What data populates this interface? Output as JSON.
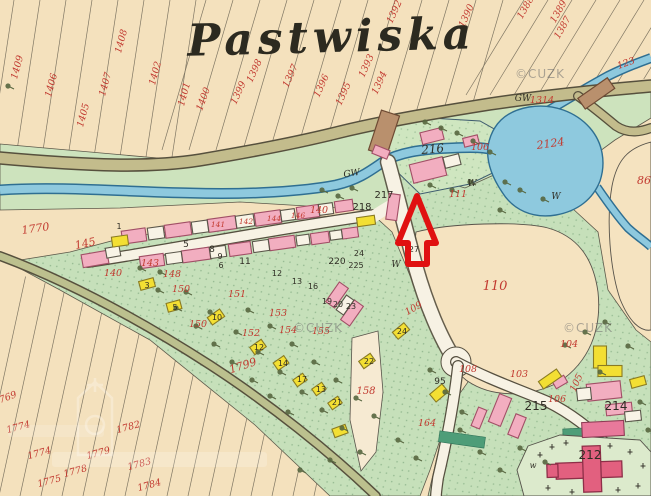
{
  "map": {
    "title": "Pastwiska",
    "watermark": "©CUZK",
    "arrow_color": "#e01111",
    "palette": {
      "field_cream": "#f4e1bd",
      "meadow_green": "#cde3bd",
      "garden_green": "#c6e0ba",
      "water_blue": "#8ec9de",
      "road_olive": "#c3bc8c",
      "road_white": "#f7f2e4",
      "building_pink": "#f2aec0",
      "building_yellow": "#f3df33",
      "church_red": "#e2607f",
      "bridge_brown": "#b9906d",
      "number_red": "#c23a30",
      "ink_black": "#2f2d24"
    },
    "parcel_numbers_red": [
      [
        "1409",
        20,
        68,
        -75
      ],
      [
        "1408",
        124,
        42,
        -75
      ],
      [
        "1407",
        108,
        85,
        -75
      ],
      [
        "1406",
        54,
        86,
        -75
      ],
      [
        "1405",
        86,
        116,
        -75
      ],
      [
        "1402",
        158,
        74,
        -75
      ],
      [
        "1401",
        187,
        95,
        -75
      ],
      [
        "1400",
        206,
        100,
        -70
      ],
      [
        "1399",
        241,
        94,
        -65
      ],
      [
        "1398",
        257,
        72,
        -65
      ],
      [
        "1397",
        293,
        77,
        -65
      ],
      [
        "1396",
        324,
        87,
        -65
      ],
      [
        "1395",
        346,
        95,
        -65
      ],
      [
        "1394",
        382,
        84,
        -65
      ],
      [
        "1393",
        369,
        67,
        -65
      ],
      [
        "1392",
        397,
        13,
        -65
      ],
      [
        "1390",
        469,
        17,
        -65
      ],
      [
        "1388",
        528,
        9,
        -60
      ],
      [
        "1389",
        561,
        13,
        -60
      ],
      [
        "1387",
        565,
        29,
        -60
      ],
      [
        "123",
        627,
        66,
        -20
      ],
      [
        "1314",
        542,
        103,
        0
      ],
      [
        "2124",
        551,
        147,
        -8,
        11
      ],
      [
        "86",
        644,
        184,
        0,
        11
      ],
      [
        "1770",
        36,
        232,
        -8,
        11
      ],
      [
        "145",
        86,
        247,
        -12,
        11
      ],
      [
        "140",
        113,
        276,
        0
      ],
      [
        "140",
        319,
        213,
        0
      ],
      [
        "143",
        150,
        266,
        0
      ],
      [
        "141",
        218,
        227,
        0,
        7.5
      ],
      [
        "142",
        246,
        224,
        0,
        7.5
      ],
      [
        "144",
        274,
        221,
        0,
        7.5
      ],
      [
        "146",
        298,
        218,
        0,
        7.5
      ],
      [
        "148",
        172,
        277,
        0
      ],
      [
        "150",
        181,
        292,
        0
      ],
      [
        "150",
        198,
        327,
        0
      ],
      [
        "151",
        237,
        297,
        0
      ],
      [
        "152",
        251,
        336,
        0
      ],
      [
        "153",
        278,
        316,
        0
      ],
      [
        "154",
        288,
        333,
        0
      ],
      [
        "155",
        321,
        334,
        0
      ],
      [
        "158",
        366,
        394,
        0,
        10
      ],
      [
        "1799",
        244,
        369,
        -18,
        11
      ],
      [
        "1769",
        6,
        401,
        -20
      ],
      [
        "1774",
        19,
        430,
        -15
      ],
      [
        "1774",
        40,
        456,
        -15
      ],
      [
        "1779",
        99,
        456,
        -15
      ],
      [
        "1778",
        76,
        474,
        -15
      ],
      [
        "1775",
        50,
        484,
        -15
      ],
      [
        "1782",
        129,
        430,
        -15
      ],
      [
        "1783",
        140,
        467,
        -15
      ],
      [
        "1784",
        150,
        488,
        -15
      ],
      [
        "106",
        480,
        150,
        0
      ],
      [
        "111",
        458,
        197,
        0
      ],
      [
        "110",
        495,
        290,
        0,
        13
      ],
      [
        "109",
        415,
        311,
        -30
      ],
      [
        "108",
        468,
        372,
        0
      ],
      [
        "104",
        569,
        347,
        0
      ],
      [
        "103",
        519,
        377,
        0
      ],
      [
        "105",
        579,
        384,
        -65
      ],
      [
        "106",
        557,
        402,
        0
      ],
      [
        "164",
        427,
        426,
        0
      ]
    ],
    "labels_black": [
      [
        "GW",
        352,
        176,
        -8,
        9,
        "i"
      ],
      [
        "GW",
        523,
        101,
        0,
        9,
        "i"
      ],
      [
        "W",
        472,
        186,
        0,
        9,
        "i"
      ],
      [
        "W",
        396,
        267,
        0,
        9,
        "i"
      ],
      [
        "W",
        556,
        199,
        0,
        9,
        "i"
      ],
      [
        "w",
        533,
        468,
        0,
        8,
        "i"
      ],
      [
        "216",
        433,
        153,
        -5,
        12,
        "i"
      ],
      [
        "217",
        384,
        198,
        0,
        10
      ],
      [
        "218",
        362,
        210,
        0,
        10
      ],
      [
        "220",
        337,
        264,
        0,
        9
      ],
      [
        "225",
        356,
        268,
        0,
        8
      ],
      [
        "24",
        359,
        256,
        0,
        8
      ],
      [
        "27",
        414,
        252,
        0,
        8
      ],
      [
        "212",
        590,
        459,
        0,
        12
      ],
      [
        "214",
        616,
        410,
        0,
        12
      ],
      [
        "215",
        536,
        410,
        0,
        12
      ],
      [
        "1",
        119,
        229,
        0,
        8
      ],
      [
        "3",
        147,
        288,
        0,
        8
      ],
      [
        "5",
        186,
        247,
        0,
        9
      ],
      [
        "8",
        212,
        252,
        0,
        9
      ],
      [
        "6",
        221,
        268,
        0,
        8
      ],
      [
        "9",
        220,
        259,
        0,
        8
      ],
      [
        "11",
        245,
        264,
        0,
        9
      ],
      [
        "12",
        277,
        276,
        0,
        8
      ],
      [
        "13",
        297,
        284,
        0,
        8
      ],
      [
        "16",
        313,
        289,
        0,
        8
      ],
      [
        "19",
        327,
        304,
        0,
        8
      ],
      [
        "20",
        338,
        307,
        0,
        8
      ],
      [
        "23",
        351,
        309,
        0,
        8
      ],
      [
        "5",
        175,
        310,
        0,
        8
      ],
      [
        "10",
        217,
        320,
        0,
        8
      ],
      [
        "12",
        259,
        350,
        0,
        8
      ],
      [
        "14",
        283,
        366,
        0,
        8
      ],
      [
        "17",
        302,
        382,
        0,
        8
      ],
      [
        "13",
        321,
        392,
        0,
        8
      ],
      [
        "21",
        337,
        405,
        0,
        8
      ],
      [
        "22",
        369,
        364,
        0,
        8
      ],
      [
        "24",
        402,
        334,
        0,
        8
      ],
      [
        "95",
        440,
        384,
        0,
        9
      ]
    ]
  }
}
